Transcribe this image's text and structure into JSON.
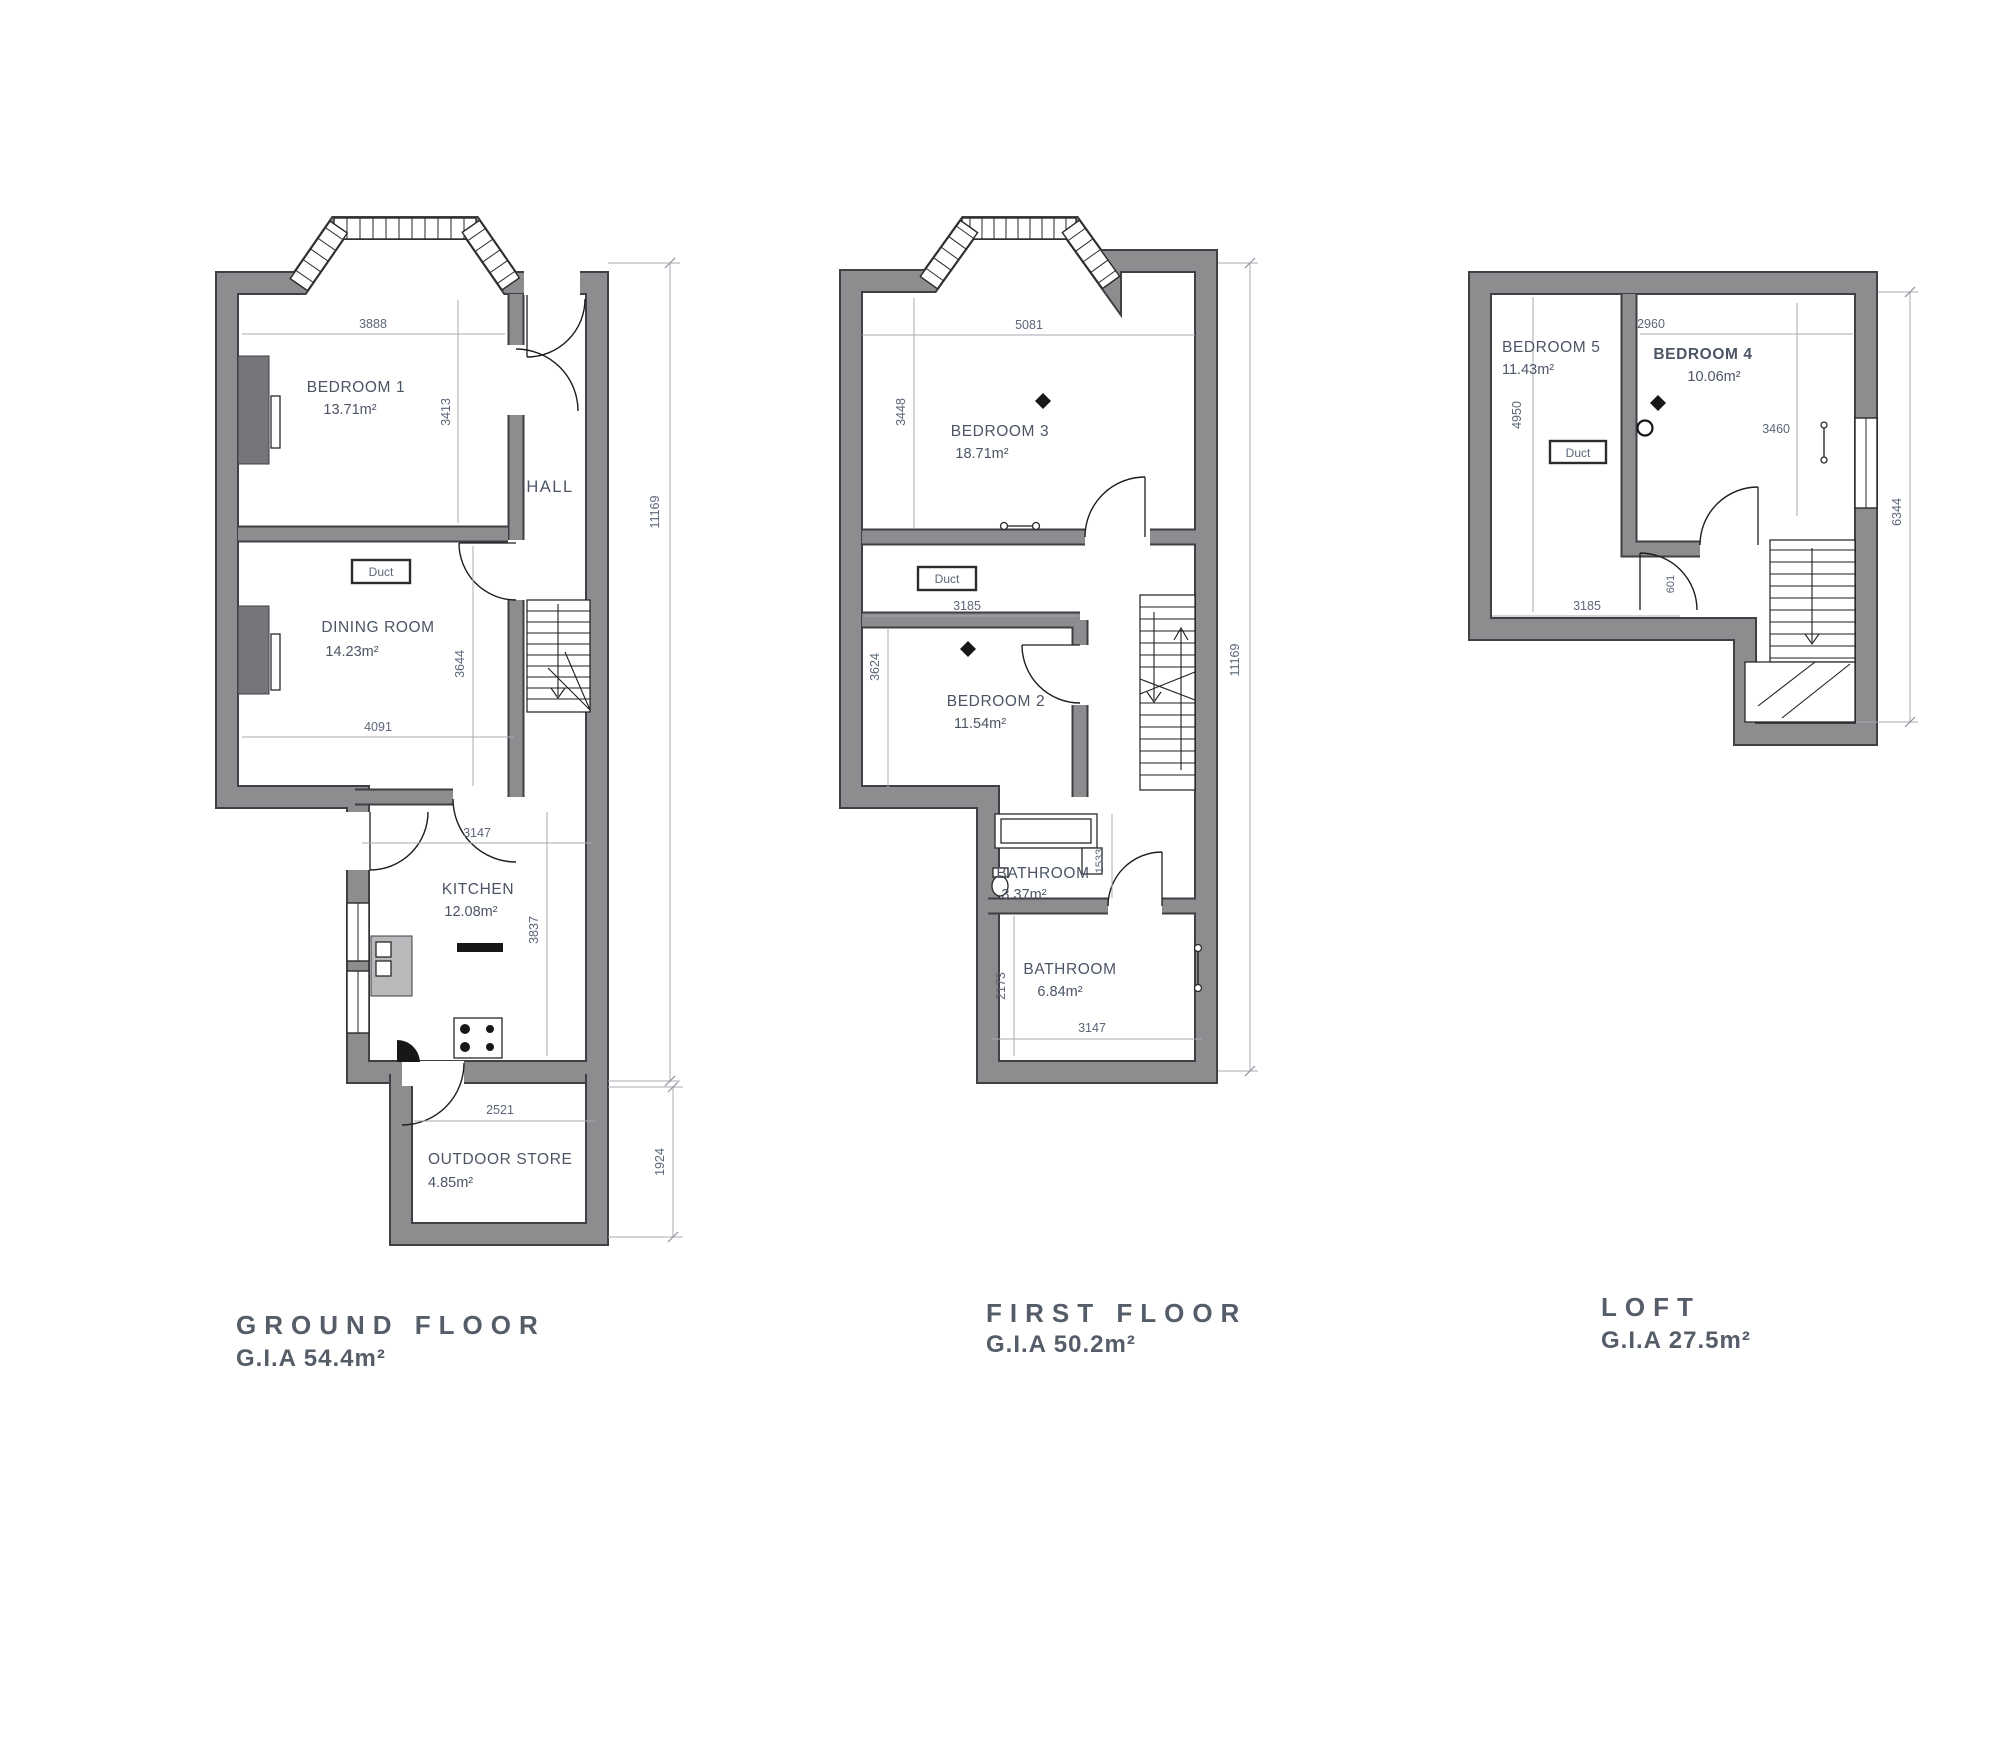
{
  "sheet": {
    "background": "#ffffff",
    "wall_color": "#8d8d90",
    "wall_edge_color": "#3f3f44",
    "text_color": "#4c5565",
    "dim_color": "#5c6678"
  },
  "floors": {
    "ground": {
      "title": "GROUND FLOOR",
      "gia": "G.I.A 54.4m²",
      "rooms": {
        "bedroom1": {
          "name": "BEDROOM 1",
          "area": "13.71m²"
        },
        "dining": {
          "name": "DINING ROOM",
          "area": "14.23m²"
        },
        "hall": {
          "name": "HALL"
        },
        "kitchen": {
          "name": "KITCHEN",
          "area": "12.08m²"
        },
        "store": {
          "name": "OUTDOOR STORE",
          "area": "4.85m²"
        }
      },
      "duct_label": "Duct",
      "dims": {
        "bedroom1_w": "3888",
        "bedroom1_h": "3413",
        "dining_w": "4091",
        "dining_h": "3644",
        "kitchen_w": "3147",
        "kitchen_h": "3837",
        "store_w": "2521",
        "store_h": "1924",
        "overall_h": "11169"
      }
    },
    "first": {
      "title": "FIRST FLOOR",
      "gia": "G.I.A 50.2m²",
      "rooms": {
        "bedroom3": {
          "name": "BEDROOM 3",
          "area": "18.71m²"
        },
        "bedroom2": {
          "name": "BEDROOM 2",
          "area": "11.54m²"
        },
        "bathroom_small": {
          "name": "BATHROOM",
          "area": "3.37m²"
        },
        "bathroom": {
          "name": "BATHROOM",
          "area": "6.84m²"
        }
      },
      "duct_label": "Duct",
      "dims": {
        "bedroom3_w": "5081",
        "bedroom3_h": "3448",
        "bedroom2_w": "3185",
        "bedroom2_h": "3624",
        "bathroom_small_h": "1533",
        "bathroom_w": "3147",
        "bathroom_h": "2173",
        "overall_h": "11169"
      }
    },
    "loft": {
      "title": "LOFT",
      "gia": "G.I.A 27.5m²",
      "rooms": {
        "bedroom5": {
          "name": "BEDROOM 5",
          "area": "11.43m²"
        },
        "bedroom4": {
          "name": "BEDROOM 4",
          "area": "10.06m²"
        }
      },
      "duct_label": "Duct",
      "dims": {
        "bedroom4_w": "2960",
        "bedroom4_h": "3460",
        "bedroom5_w": "3185",
        "bedroom5_h": "4950",
        "door_w": "601",
        "overall_h": "6344"
      }
    }
  }
}
